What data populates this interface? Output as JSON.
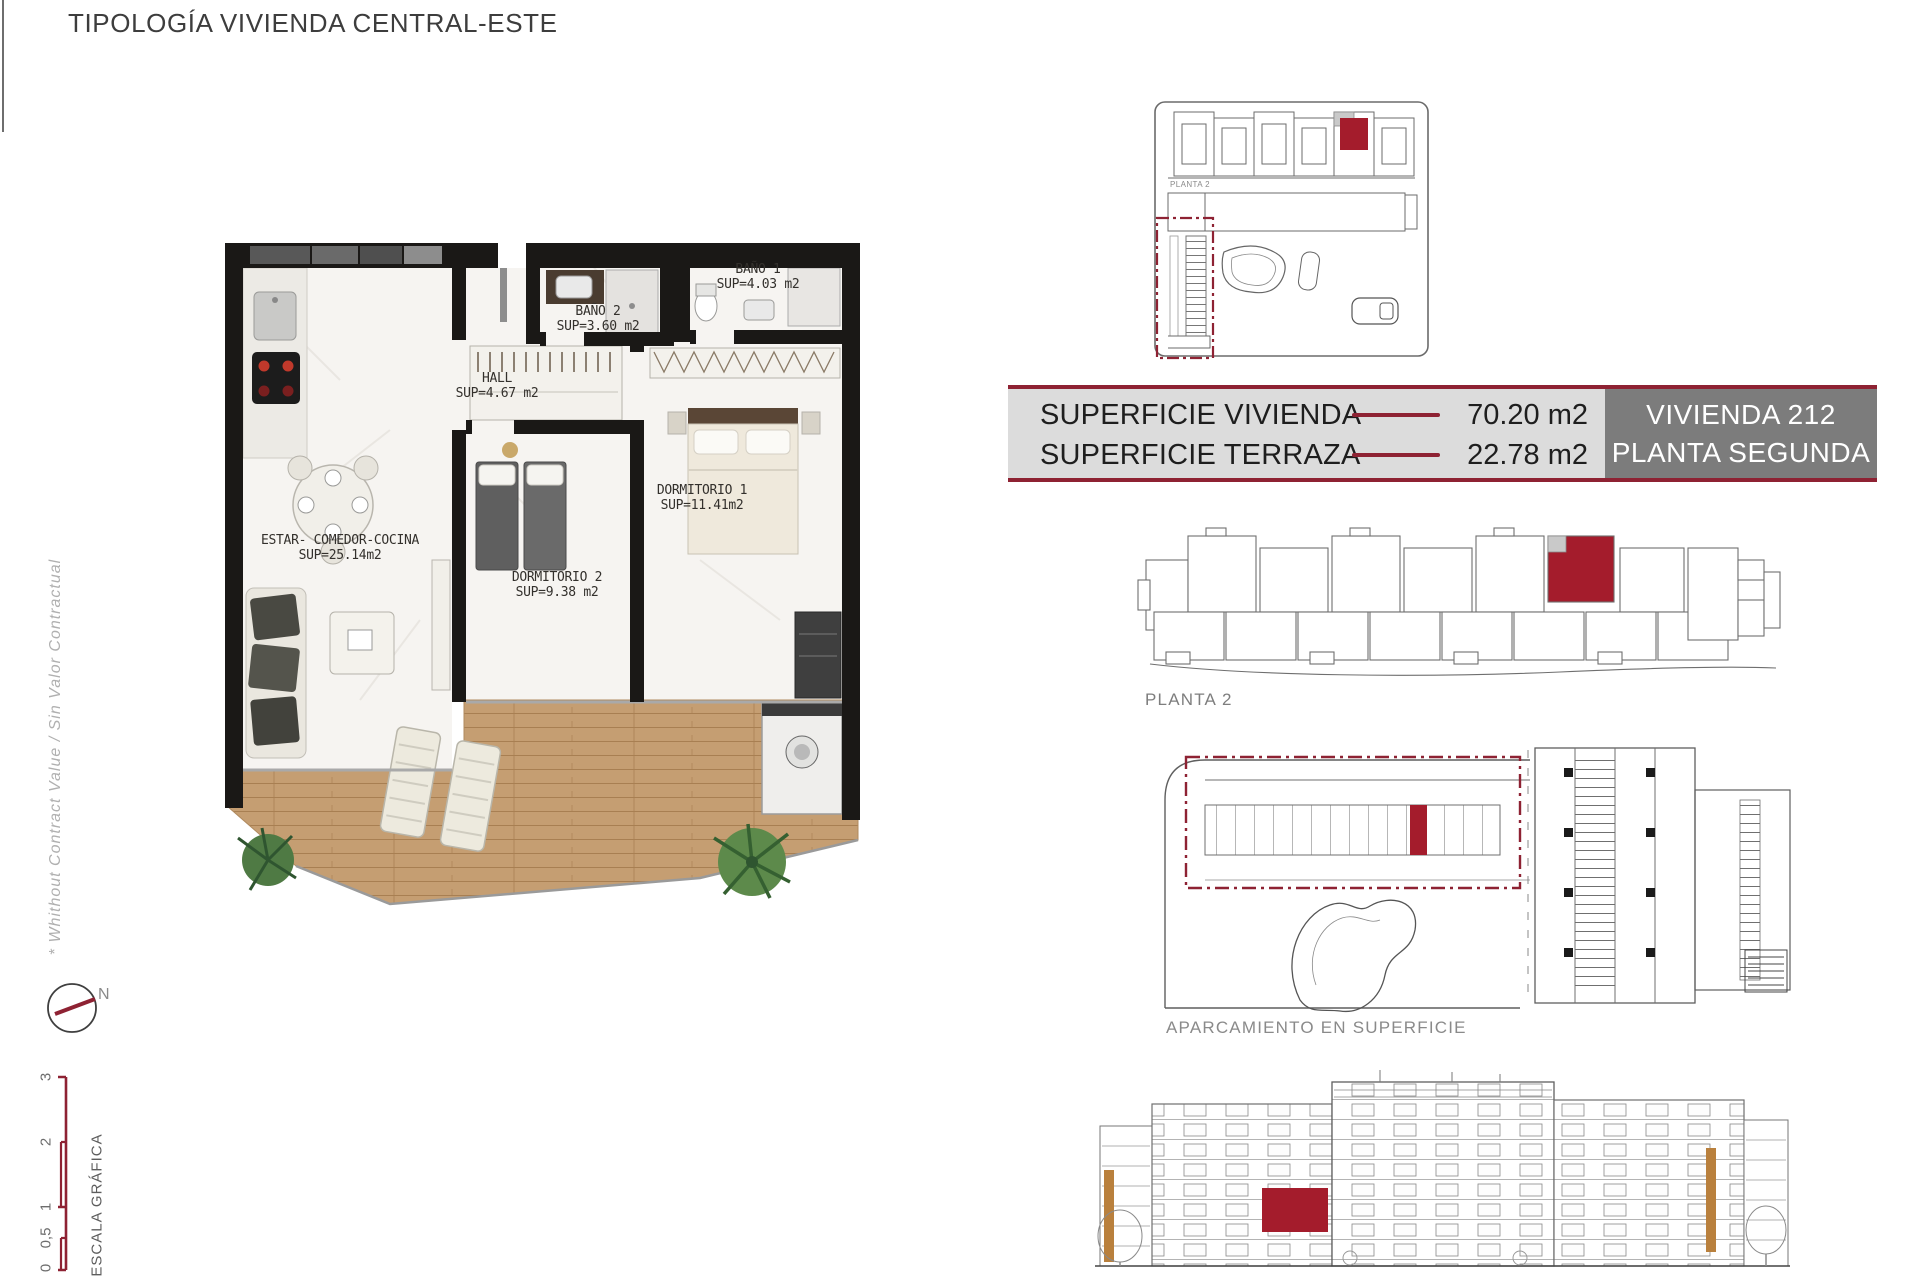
{
  "title": "TIPOLOGÍA VIVIENDA CENTRAL-ESTE",
  "disclaimer": "* Whithout Contract Value / Sin Valor Contractual",
  "compass": {
    "label": "N"
  },
  "scale_bar": {
    "label": "ESCALA GRÁFICA",
    "ticks": [
      "3",
      "2",
      "1",
      "0,5",
      "0"
    ]
  },
  "floor_plan": {
    "rooms": {
      "bano1": {
        "name": "BAÑO 1",
        "area": "SUP=4.03 m2"
      },
      "bano2": {
        "name": "BAÑO 2",
        "area": "SUP=3.60 m2"
      },
      "hall": {
        "name": "HALL",
        "area": "SUP=4.67 m2"
      },
      "dormitorio1": {
        "name": "DORMITORIO 1",
        "area": "SUP=11.41m2"
      },
      "dormitorio2": {
        "name": "DORMITORIO 2",
        "area": "SUP=9.38 m2"
      },
      "estar": {
        "name": "ESTAR- COMEDOR-COCINA",
        "area": "SUP=25.14m2"
      }
    }
  },
  "summary": {
    "row1_label": "SUPERFICIE VIVIENDA",
    "row1_value": "70.20 m2",
    "row2_label": "SUPERFICIE TERRAZA",
    "row2_value": "22.78 m2",
    "unit_line1": "VIVIENDA 212",
    "unit_line2": "PLANTA SEGUNDA"
  },
  "labels": {
    "site_plan": "PLANTA 2",
    "floor_key": "PLANTA 2",
    "parking": "APARCAMIENTO EN SUPERFICIE"
  },
  "colors": {
    "accent": "#8e2233",
    "highlight": "#a41c2c",
    "table_bg": "#dcdcdc",
    "unit_box": "#7c7c7c"
  }
}
